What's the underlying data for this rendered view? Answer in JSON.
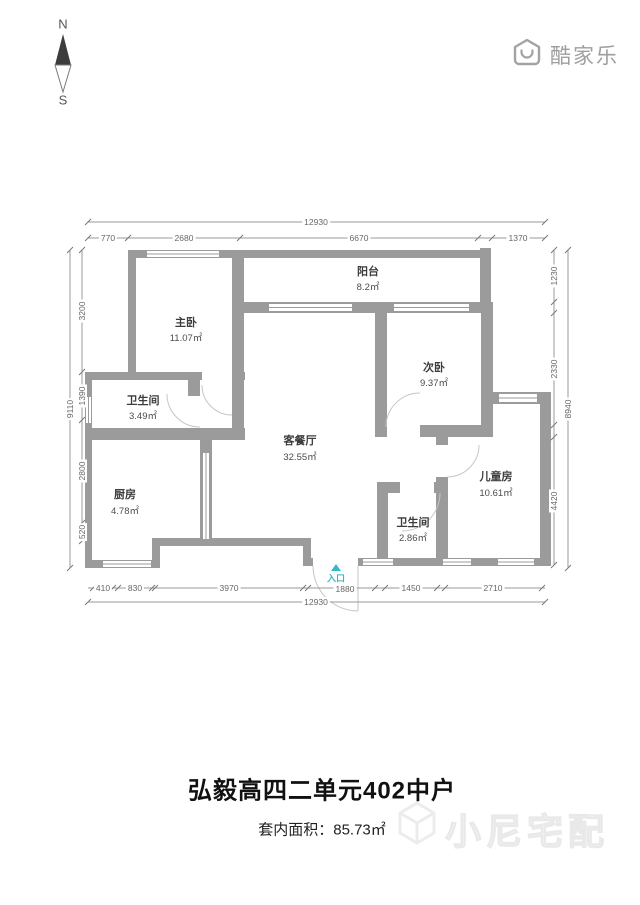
{
  "compass": {
    "north": "N",
    "south": "S"
  },
  "brand": {
    "logo_text": "酷家乐"
  },
  "rooms": [
    {
      "name": "主卧",
      "area": "11.07㎡"
    },
    {
      "name": "阳台",
      "area": "8.2㎡"
    },
    {
      "name": "次卧",
      "area": "9.37㎡"
    },
    {
      "name": "卫生间",
      "area": "3.49㎡"
    },
    {
      "name": "客餐厅",
      "area": "32.55㎡"
    },
    {
      "name": "厨房",
      "area": "4.78㎡"
    },
    {
      "name": "儿童房",
      "area": "10.61㎡"
    },
    {
      "name": "卫生间",
      "area": "2.86㎡"
    }
  ],
  "entrance": {
    "label": "入口"
  },
  "dimensions": {
    "top_total": "12930",
    "top_segments": [
      "770",
      "2680",
      "6670",
      "1370"
    ],
    "bottom_segments": [
      "410",
      "830",
      "3970",
      "1880",
      "1450",
      "2710"
    ],
    "bottom_total": "12930",
    "left_total": "9110",
    "left_segments": [
      "3200",
      "1390",
      "2800",
      "520"
    ],
    "right_total": "8940",
    "right_segments": [
      "1230",
      "2330",
      "4420"
    ]
  },
  "footer": {
    "title": "弘毅高四二单元402中户",
    "area_label": "套内面积：",
    "area_value": "85.73㎡",
    "watermark": "小尼宅配"
  },
  "colors": {
    "wall": "#9b9b9b",
    "entrance_accent": "#3eb5c5"
  }
}
